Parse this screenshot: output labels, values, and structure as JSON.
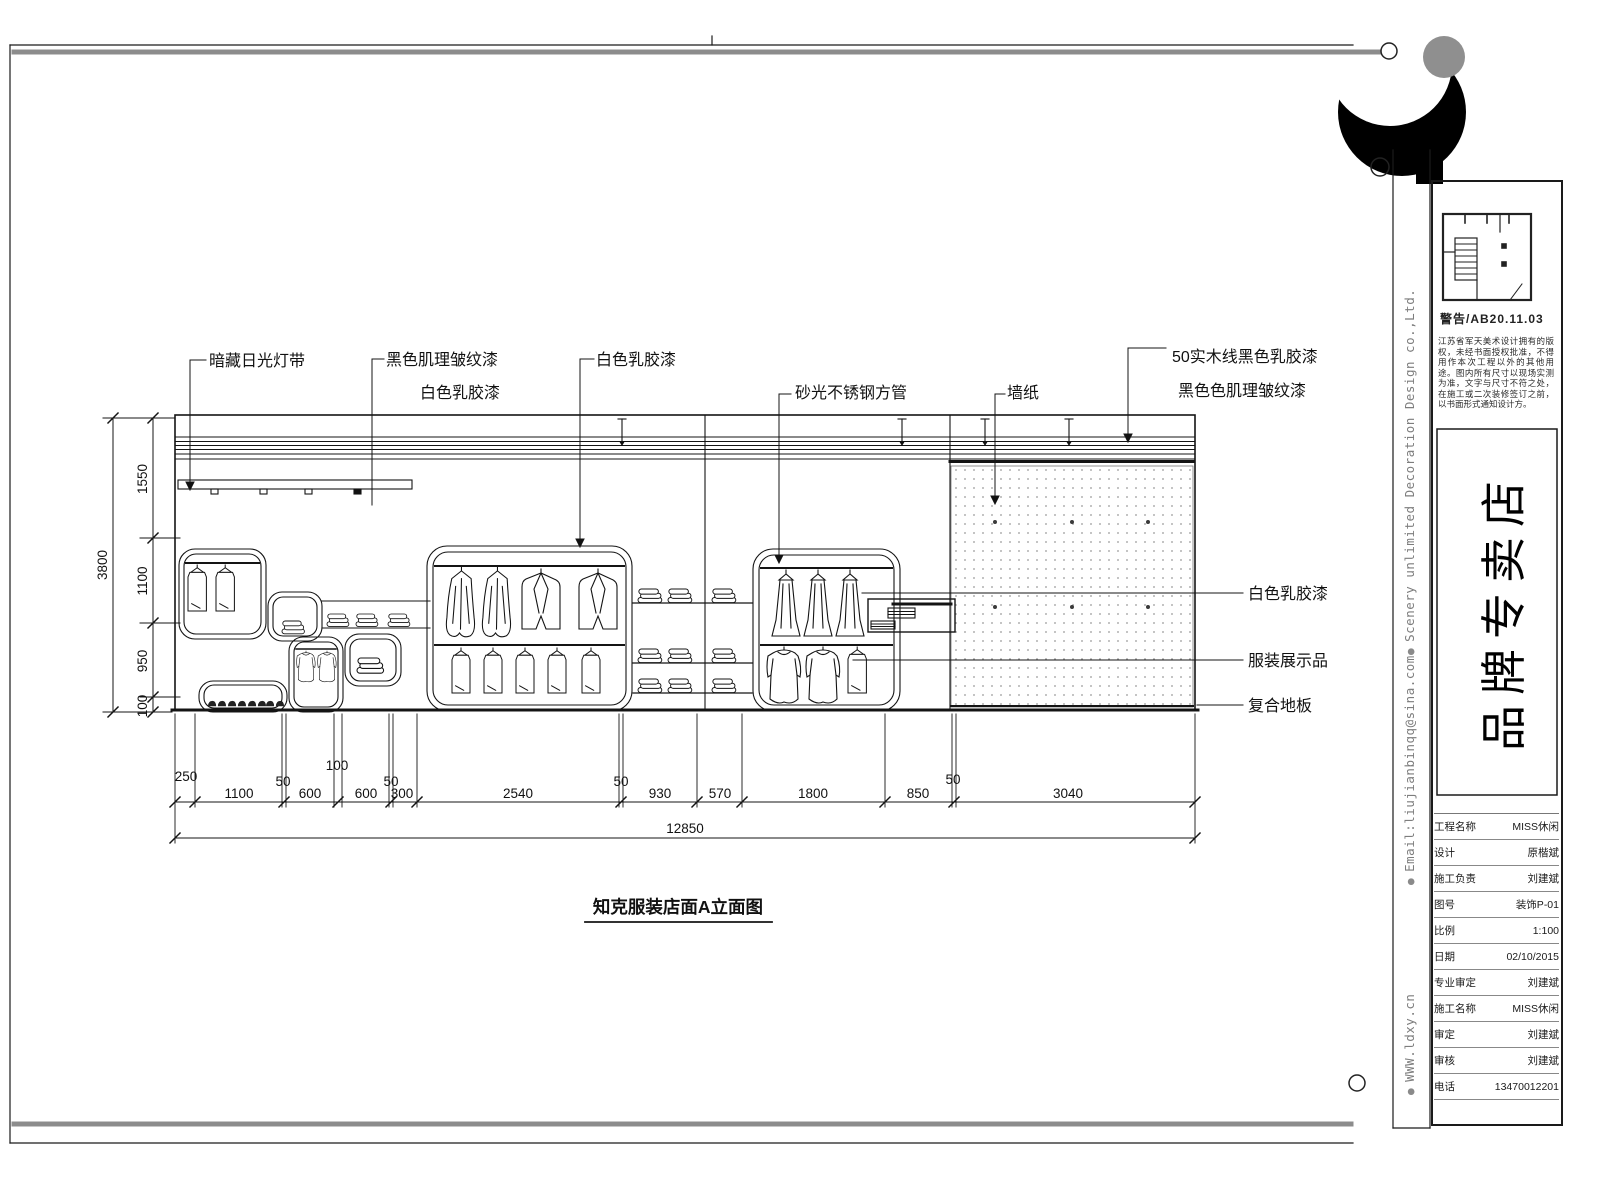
{
  "drawing": {
    "title": "知克服装店面A立面图",
    "callouts_top": [
      "暗藏日光灯带",
      "黑色肌理皱纹漆",
      "白色乳胶漆",
      "白色乳胶漆",
      "砂光不锈钢方管",
      "墙纸",
      "50实木线黑色乳胶漆",
      "黑色色肌理皱纹漆"
    ],
    "callouts_right": [
      "白色乳胶漆",
      "服装展示品",
      "复合地板"
    ],
    "dims_left": {
      "overall": "3800",
      "segments": [
        "1550",
        "1100",
        "950",
        "100"
      ]
    },
    "dims_bottom": {
      "overall": "12850",
      "segments": [
        "250",
        "1100",
        "50",
        "600",
        "100",
        "600",
        "50",
        "300",
        "2540",
        "50",
        "930",
        "570",
        "1800",
        "850",
        "50",
        "3040"
      ]
    }
  },
  "sidebar": {
    "company": "Scenery unlimited Decoration Design co.,Ltd.",
    "email": "Email:liujianbinqq@sina.com",
    "website": "WWW.ldxy.cn"
  },
  "titleblock": {
    "stamp": "警告/AB20.11.03",
    "disclaimer": "江苏省军天美术设计拥有的版权，未经书面授权批准，不得用作本次工程以外的其他用途。图内所有尺寸以现场实测为准，文字与尺寸不符之处，在施工或二次装修签订之前，以书面形式通知设计方。",
    "brand": "品牌专卖店",
    "table": [
      {
        "label": "工程名称",
        "value": "MISS休闲"
      },
      {
        "label": "设计",
        "value": "原楷斌"
      },
      {
        "label": "施工负责",
        "value": "刘建斌"
      },
      {
        "label": "图号",
        "value": "装饰P-01"
      },
      {
        "label": "比例",
        "value": "1:100"
      },
      {
        "label": "日期",
        "value": "02/10/2015"
      },
      {
        "label": "专业审定",
        "value": "刘建斌"
      },
      {
        "label": "施工名称",
        "value": "MISS休闲"
      },
      {
        "label": "审定",
        "value": "刘建斌"
      },
      {
        "label": "审核",
        "value": "刘建斌"
      },
      {
        "label": "电话",
        "value": "13470012201"
      }
    ]
  }
}
